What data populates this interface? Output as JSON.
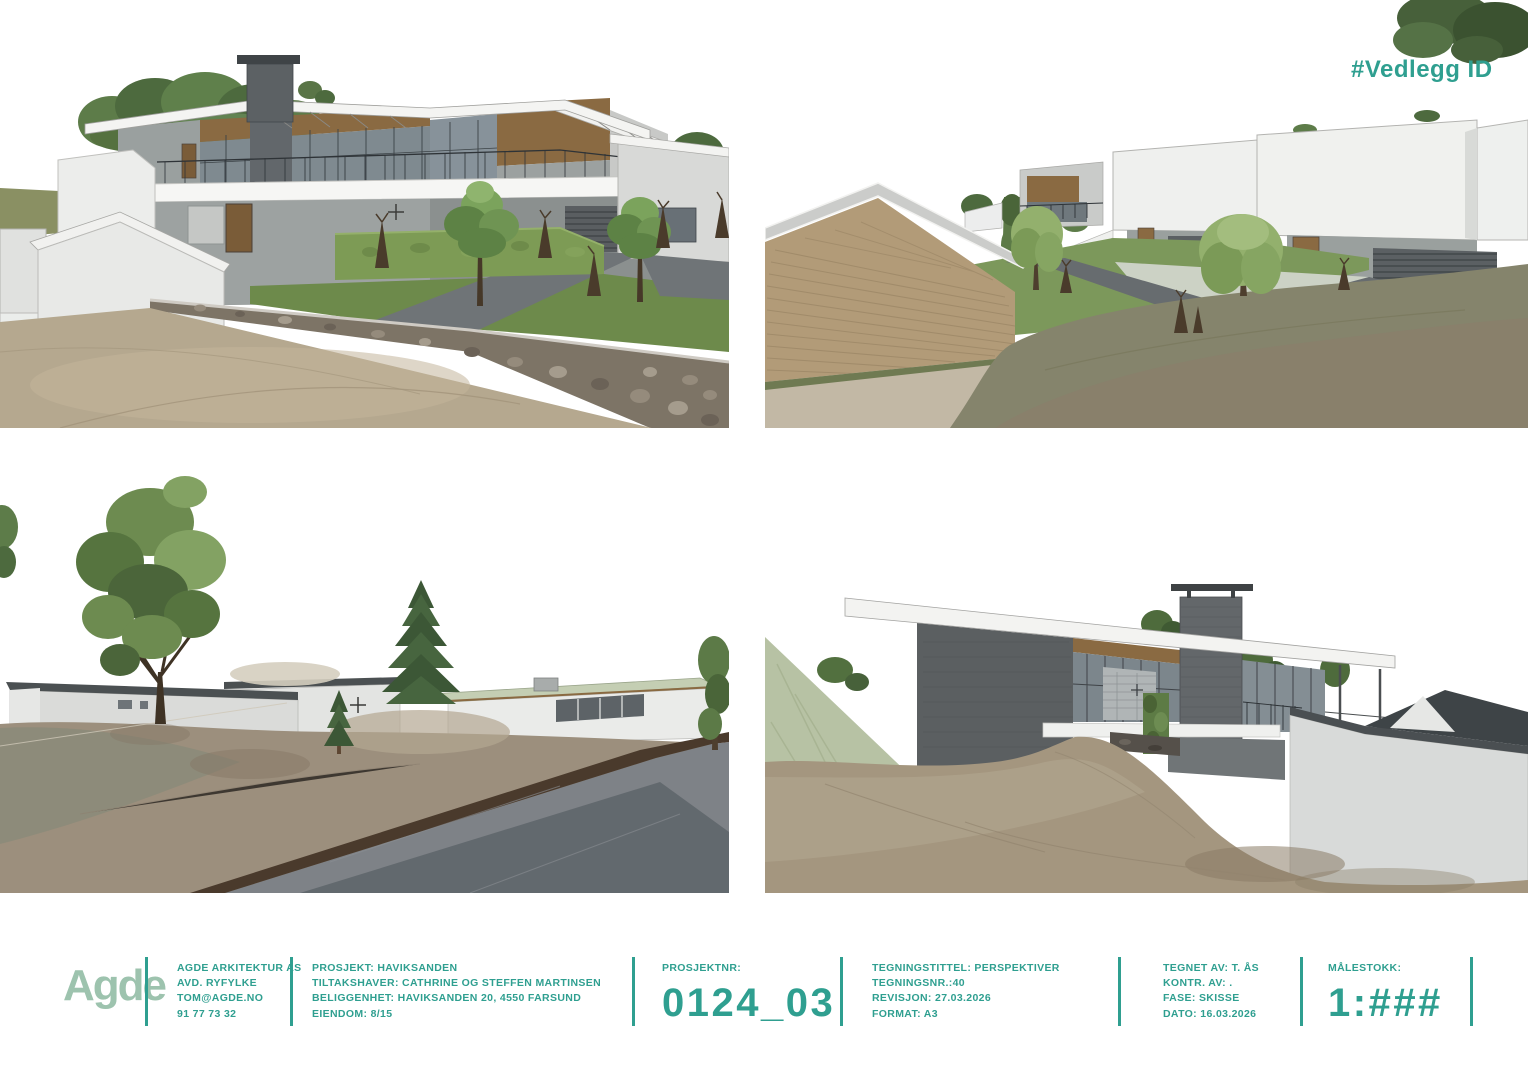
{
  "sheet": {
    "attachment_tag": "#Vedlegg ID"
  },
  "views": {
    "v1": "perspective-street-view",
    "v2": "perspective-courtyard-view",
    "v3": "perspective-road-view",
    "v4": "perspective-dune-view"
  },
  "title_block": {
    "logo": "Agde",
    "office": {
      "line1": "AGDE ARKITEKTUR AS",
      "line2": "AVD. RYFYLKE",
      "line3": "TOM@AGDE.NO",
      "line4": "91 77 73 32"
    },
    "project": {
      "line1": "PROSJEKT: HAVIKSANDEN",
      "line2": "TILTAKSHAVER: CATHRINE OG STEFFEN MARTINSEN",
      "line3": "BELIGGENHET: HAVIKSANDEN 20, 4550 FARSUND",
      "line4": "EIENDOM: 8/15"
    },
    "project_number": {
      "label": "PROSJEKTNR:",
      "value": "0124_03"
    },
    "drawing": {
      "line1": "TEGNINGSTITTEL: PERSPEKTIVER",
      "line2": "TEGNINGSNR.:40",
      "line3": "REVISJON: 27.03.2026",
      "line4": "FORMAT: A3"
    },
    "credits": {
      "line1": "TEGNET AV: T. ÅS",
      "line2": "KONTR. AV: .",
      "line3": "FASE: SKISSE",
      "line4": "DATO: 16.03.2026"
    },
    "scale": {
      "label": "MÅLESTOKK:",
      "value": "1:###"
    }
  },
  "colors": {
    "accent_teal": "#2f9f90",
    "logo_green": "#9dc3ae",
    "background": "#ffffff",
    "wood": "#8a6a42",
    "concrete": "#9da2a1",
    "lawn": "#6d8a4b",
    "sand": "#b5a88f",
    "road": "#656b6f"
  }
}
